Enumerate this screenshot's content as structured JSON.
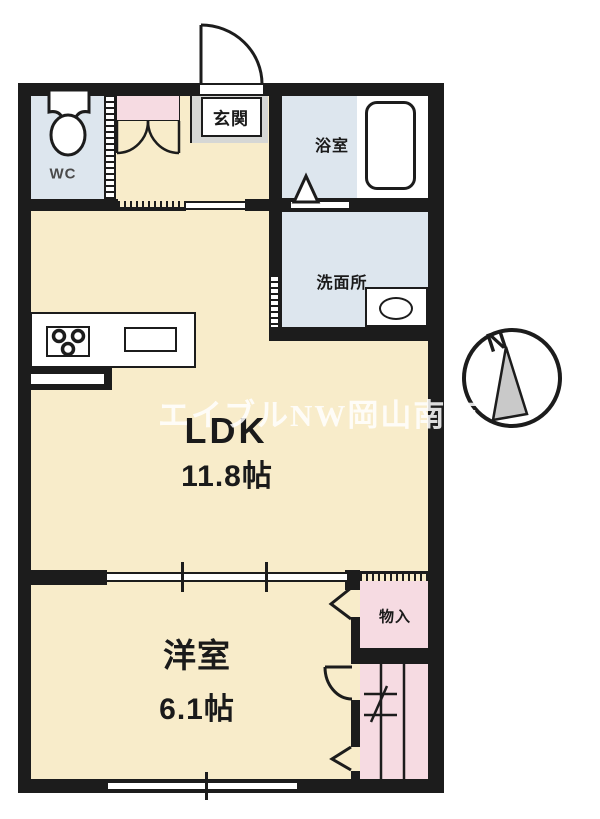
{
  "floorplan": {
    "type": "apartment-floor-plan",
    "rooms": {
      "wc": {
        "label": "WC"
      },
      "entrance": {
        "label": "玄関"
      },
      "bathroom": {
        "label": "浴室"
      },
      "washroom": {
        "label": "洗面所"
      },
      "ldk": {
        "label": "LDK",
        "size": "11.8帖"
      },
      "western_room": {
        "label": "洋室",
        "size": "6.1帖"
      },
      "storage": {
        "label": "物入"
      }
    },
    "compass": {
      "north_label": "N"
    },
    "watermark": {
      "text": "エイブルNW岡山南店"
    },
    "colors": {
      "floor_cream": "#f8ecca",
      "floor_pink": "#f6dbe2",
      "floor_blue": "#dde6ee",
      "entrance_gray": "#d6d7d5",
      "wall_black": "#1c1c1c",
      "watermark_white": "#ffffff"
    }
  }
}
